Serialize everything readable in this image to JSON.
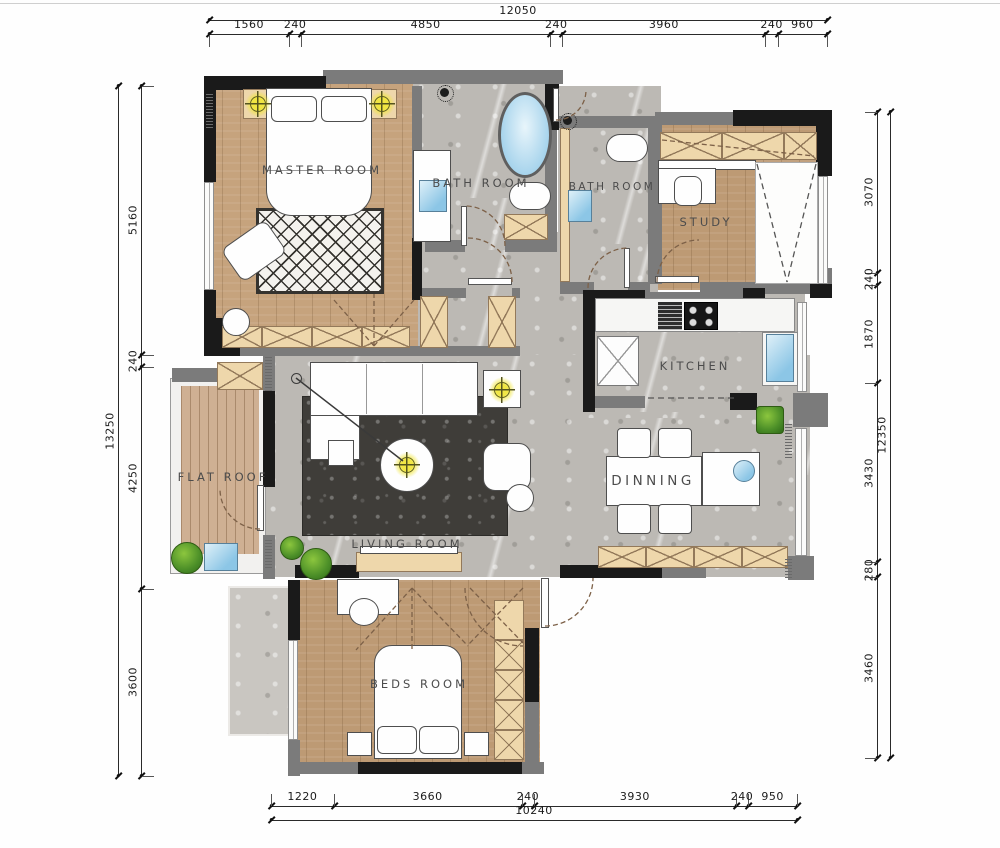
{
  "rooms": [
    {
      "id": "master",
      "label": "MASTER ROOM"
    },
    {
      "id": "bath-1",
      "label": "BATH ROOM"
    },
    {
      "id": "bath-2",
      "label": "BATH ROOM"
    },
    {
      "id": "study",
      "label": "STUDY"
    },
    {
      "id": "kitchen",
      "label": "KITCHEN"
    },
    {
      "id": "dinning",
      "label": "DINNING"
    },
    {
      "id": "living",
      "label": "LIVING ROOM"
    },
    {
      "id": "flat-roof",
      "label": "FLAT ROOF"
    },
    {
      "id": "beds",
      "label": "BEDS ROOM"
    }
  ],
  "dimensions": {
    "top": {
      "total": "12050",
      "segments": [
        "1560",
        "240",
        "4850",
        "240",
        "3960",
        "240",
        "960"
      ]
    },
    "left": {
      "total": "13250",
      "segments": [
        "5160",
        "240",
        "4250",
        "3600"
      ]
    },
    "right": {
      "total": "12350",
      "segments": [
        "3070",
        "240",
        "1870",
        "3430",
        "280",
        "3460"
      ]
    },
    "bottom": {
      "total": "10240",
      "segments": [
        "1220",
        "3660",
        "240",
        "3930",
        "240",
        "950"
      ]
    }
  },
  "colors": {
    "wall_black": "#1a1a1a",
    "wall_gray": "#7b7b7b",
    "wood": "#c6a37d",
    "wood2": "#bd9a74",
    "deck": "#cfb093",
    "marble": "#bcb9b4",
    "cabinet": "#eed7ab",
    "rug_dark": "#3f3d39",
    "rug_light": "#f4f2ee",
    "water": "#8cc6e6",
    "plant": "#4c8f28",
    "light_yellow": "#f0e63c",
    "dim_text": "#1b1b1b",
    "label_text": "#4c4c4c"
  }
}
